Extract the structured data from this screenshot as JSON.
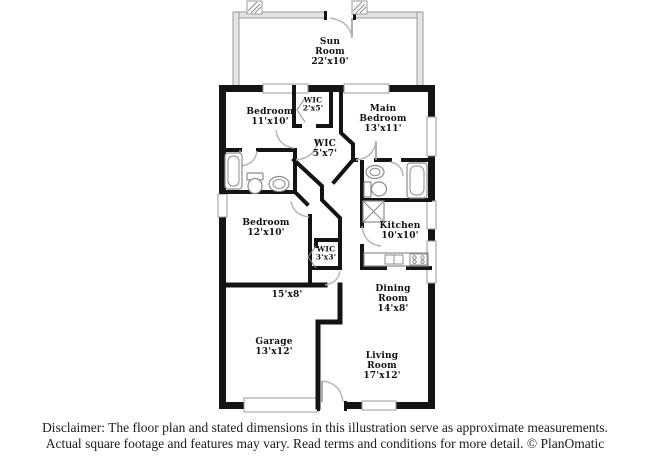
{
  "plan": {
    "rooms": {
      "sun_room": {
        "label": "Sun\nRoom\n22'x10'"
      },
      "bedroom_1": {
        "label": "Bedroom\n11'x10'"
      },
      "wic_2x5": {
        "label": "WIC\n2'x5'"
      },
      "main_bedroom": {
        "label": "Main\nBedroom\n13'x11'"
      },
      "wic_5x7": {
        "label": "WIC\n5'x7'"
      },
      "bedroom_2": {
        "label": "Bedroom\n12'x10'"
      },
      "kitchen": {
        "label": "Kitchen\n10'x10'"
      },
      "wic_3x3": {
        "label": "WIC\n3'x3'"
      },
      "area_15x8": {
        "label": "15'x8'"
      },
      "dining_room": {
        "label": "Dining\nRoom\n14'x8'"
      },
      "garage": {
        "label": "Garage\n13'x12'"
      },
      "living_room": {
        "label": "Living\nRoom\n17'x12'"
      }
    },
    "colors": {
      "wall": "#141414",
      "sun_wall_fill": "#e4e4e4",
      "sun_wall_stroke": "#9a9a9a",
      "fixture": "#8c8c8c",
      "door_arc": "#b5b5b5",
      "window_stroke": "#9a9a9a"
    }
  },
  "footer": {
    "disclaimer_line1": "Disclaimer: The floor plan and stated dimensions in this illustration serve as approximate measurements.",
    "disclaimer_line2": "Actual square footage and features may vary. Read terms and conditions for more detail. © PlanOmatic"
  }
}
